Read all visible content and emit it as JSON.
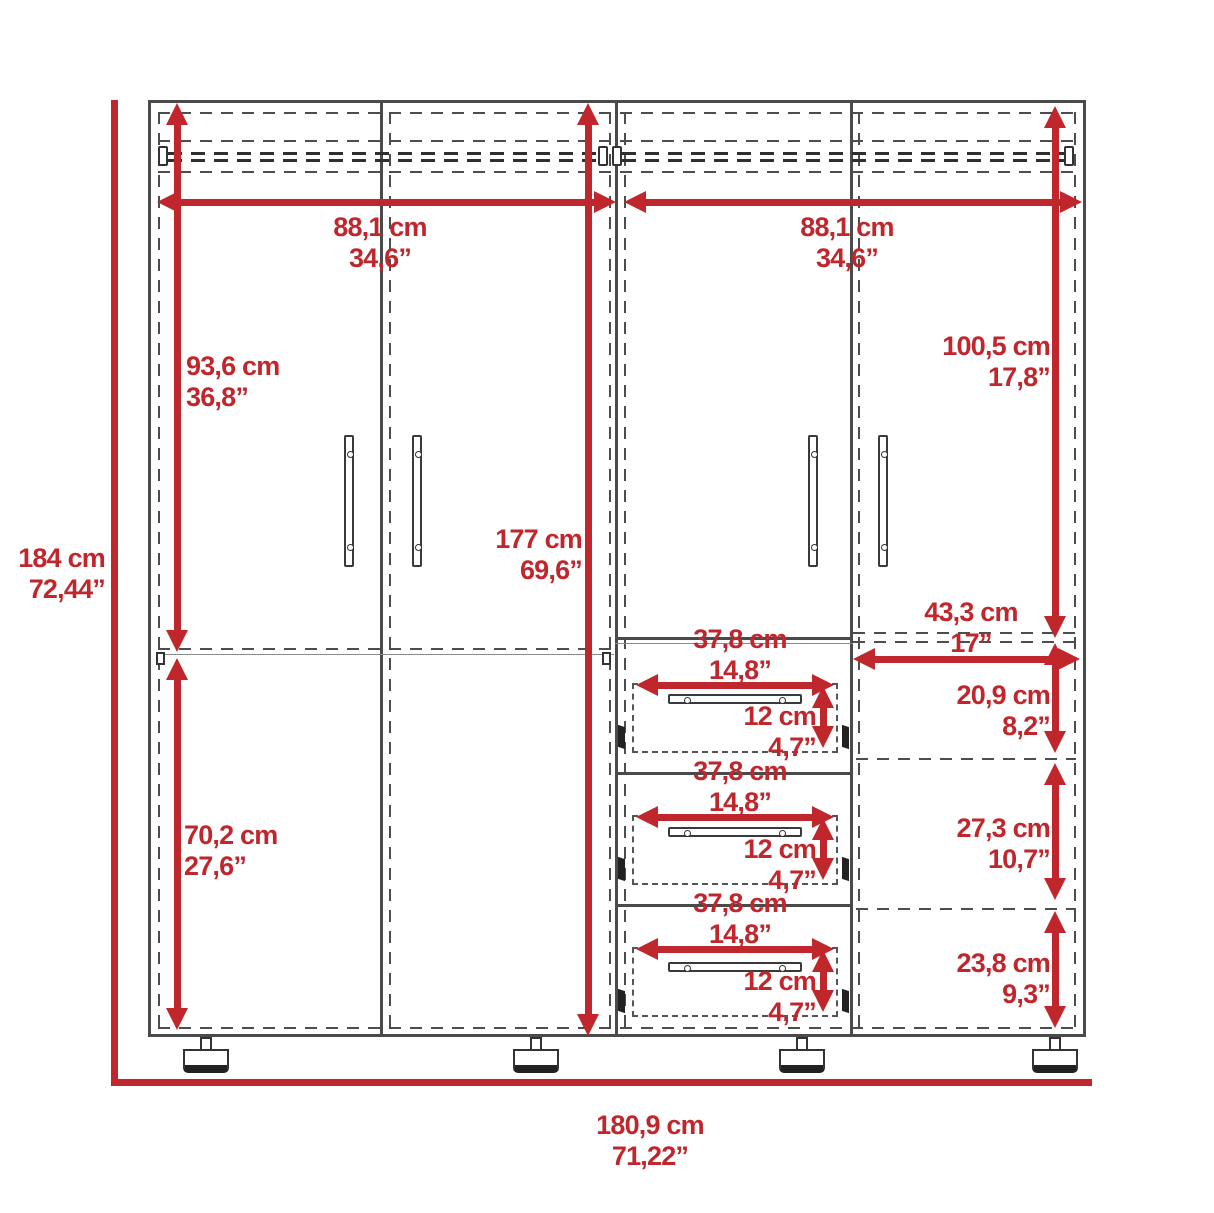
{
  "title": "Four-door armoire with drawers - dimension diagram",
  "colors": {
    "dimension_red": "#c0272d",
    "line_dark": "#4a4a4a",
    "dash_gray": "#4d4d4d",
    "background": "#ffffff"
  },
  "dims": {
    "overall_height": {
      "cm": "184 cm",
      "inch": "72,44”"
    },
    "overall_width": {
      "cm": "180,9 cm",
      "inch": "71,22”"
    },
    "left_upper_section_height": {
      "cm": "93,6 cm",
      "inch": "36,8”"
    },
    "left_lower_section_height": {
      "cm": "70,2 cm",
      "inch": "27,6”"
    },
    "interior_height": {
      "cm": "177 cm",
      "inch": "69,6”"
    },
    "left_compartment_width": {
      "cm": "88,1 cm",
      "inch": "34,6”"
    },
    "right_compartment_width": {
      "cm": "88,1 cm",
      "inch": "34,6”"
    },
    "right_upper_section_height": {
      "cm": "100,5 cm",
      "inch": "17,8”"
    },
    "right_shelf_width": {
      "cm": "43,3 cm",
      "inch": "17”"
    },
    "right_shelf_space_1": {
      "cm": "20,9 cm",
      "inch": "8,2”"
    },
    "right_shelf_space_2": {
      "cm": "27,3 cm",
      "inch": "10,7”"
    },
    "right_shelf_space_3": {
      "cm": "23,8 cm",
      "inch": "9,3”"
    },
    "drawer_width": {
      "cm": "37,8 cm",
      "inch": "14,8”"
    },
    "drawer_height": {
      "cm": "12 cm",
      "inch": "4,7”"
    }
  }
}
